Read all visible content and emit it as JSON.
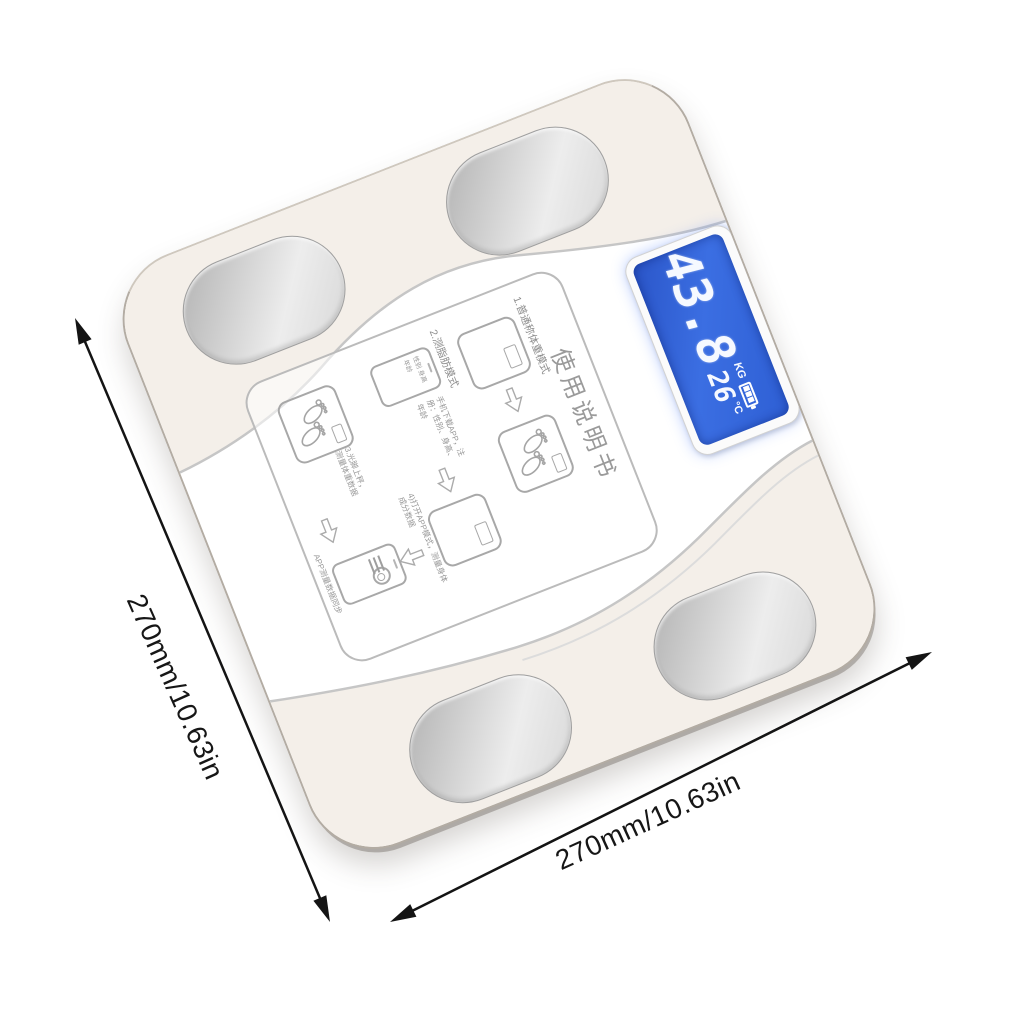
{
  "product": {
    "name": "body-fat-scale",
    "lcd": {
      "weight": "43.8",
      "weight_unit": "KG",
      "temperature": "26",
      "temperature_unit": "°C",
      "battery_icon": "battery-level-icon"
    },
    "sticker": {
      "title": "使用说明书",
      "section1_heading": "1.普通称体重模式",
      "section2_heading": "2.测脂肪模式",
      "caption_register": "手机下载APP，注册：性别、身高、年龄",
      "caption_mode": "4)打开APP模式，测量身体成分数据",
      "caption_step": "3.光脚上秤，测量体重数据",
      "caption_sync": "APP测量数据同步",
      "phone_fields": "性别 身高 年龄"
    }
  },
  "dimensions": {
    "left_label": "270mm/10.63in",
    "bottom_label": "270mm/10.63in"
  },
  "colors": {
    "lcd_blue": "#2f62d8",
    "pad_silver": "#c9c9c9",
    "annotation_black": "#161616",
    "body_beige": "#f4efe9"
  }
}
